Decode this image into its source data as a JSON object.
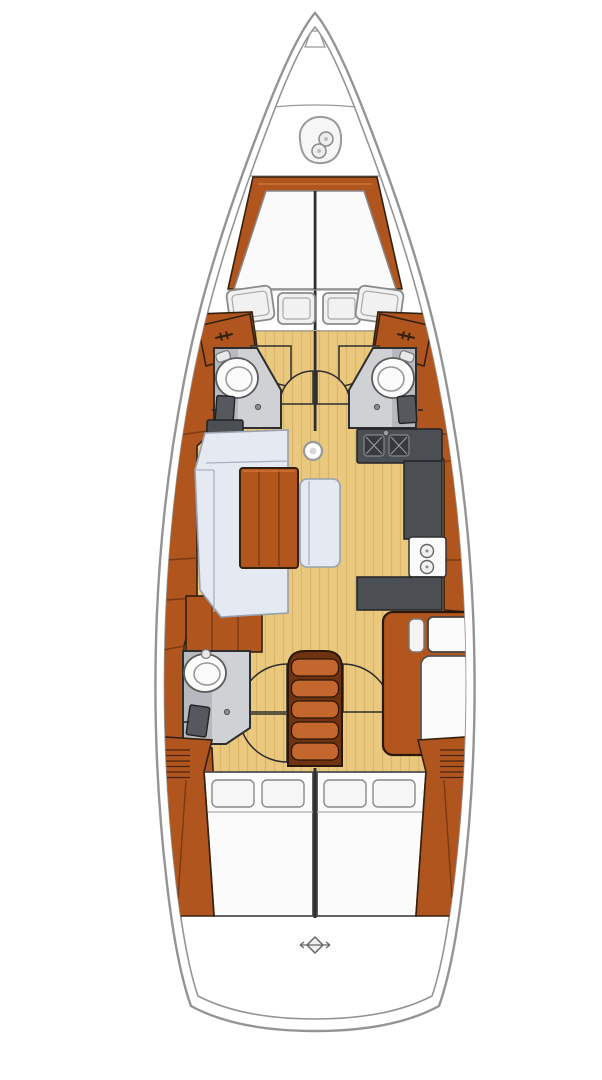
{
  "diagram": {
    "type": "sailboat-interior-floor-plan",
    "orientation": "bow-top",
    "areas": [
      "anchor-locker",
      "v-berth-forward-cabin",
      "deck-hatches",
      "forward-head-port",
      "forward-head-starboard",
      "salon-sofa",
      "salon-table",
      "salon-bench",
      "galley",
      "mast-step",
      "companionway-steps",
      "aft-head-port",
      "nav-station-starboard",
      "aft-cabin-port-bed",
      "aft-cabin-starboard-bed",
      "stern-deck",
      "swim-platform-marker"
    ],
    "icons": [
      "anchor-windlass-icon",
      "toilet-icon",
      "sink-icon",
      "stove-burners-icon",
      "door-swing-arc",
      "cabinet-latch-icon",
      "vent-louver-icon",
      "stern-drain-icon"
    ]
  },
  "colors": {
    "hullFill": "#ffffff",
    "hullStroke": "#949494",
    "woodTrim": "#b0551e",
    "woodTrimDark": "#7a3a12",
    "woodTrimOutline": "#33200f",
    "woodHighlight": "#d3793b",
    "stepOrange": "#c4672f",
    "stepSide": "#6f3312",
    "floorTan": "#eac97f",
    "floorStripe": "#d9b469",
    "counterDark": "#4b4e53",
    "counterInset": "#36393d",
    "bathFloor": "#cfd1d4",
    "bathShade": "#b6b9bd",
    "sofaBlue": "#e4e9f2",
    "sofaStroke": "#98a0b2",
    "fixtureWhite": "#fbfbfb",
    "lineDark": "#2e2e2e"
  }
}
